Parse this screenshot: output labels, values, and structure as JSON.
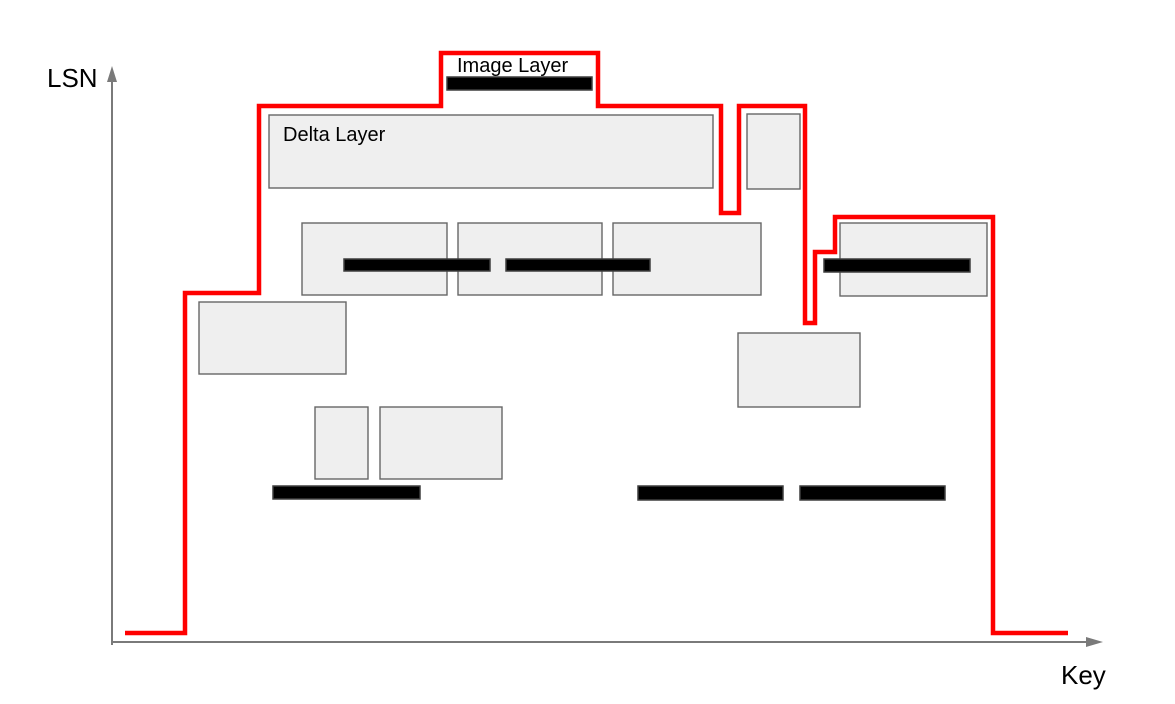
{
  "axes": {
    "y_label": "LSN",
    "x_label": "Key"
  },
  "labels": {
    "image_layer": "Image Layer",
    "delta_layer": "Delta Layer"
  },
  "colors": {
    "red_line": "#ff0000",
    "box_fill": "#efefef",
    "box_stroke": "#666666",
    "bar_fill": "#000000",
    "bar_stroke": "#3f3f3f",
    "axis": "#7a7a7a",
    "text": "#000000",
    "background": "#ffffff"
  },
  "diagram": {
    "red_boundary": {
      "name": "red-boundary-line",
      "points": [
        [
          125,
          633
        ],
        [
          185,
          633
        ],
        [
          185,
          293
        ],
        [
          259,
          293
        ],
        [
          259,
          106
        ],
        [
          441,
          106
        ],
        [
          441,
          53
        ],
        [
          598,
          53
        ],
        [
          598,
          106
        ],
        [
          721,
          106
        ],
        [
          721,
          213
        ],
        [
          739,
          213
        ],
        [
          739,
          106
        ],
        [
          805,
          106
        ],
        [
          805,
          323
        ],
        [
          815,
          323
        ],
        [
          815,
          252
        ],
        [
          835,
          252
        ],
        [
          835,
          217
        ],
        [
          993,
          217
        ],
        [
          993,
          633
        ],
        [
          1068,
          633
        ]
      ]
    },
    "delta_layer_boxes": [
      {
        "name": "delta-layer-box-main",
        "x": 269,
        "y": 115,
        "w": 444,
        "h": 73
      },
      {
        "name": "delta-layer-box-top-small",
        "x": 747,
        "y": 114,
        "w": 53,
        "h": 75
      },
      {
        "name": "delta-layer-box-mid-left",
        "x": 302,
        "y": 223,
        "w": 145,
        "h": 72
      },
      {
        "name": "delta-layer-box-mid-center",
        "x": 458,
        "y": 223,
        "w": 144,
        "h": 72
      },
      {
        "name": "delta-layer-box-mid-right",
        "x": 613,
        "y": 223,
        "w": 148,
        "h": 72
      },
      {
        "name": "delta-layer-box-right",
        "x": 840,
        "y": 223,
        "w": 147,
        "h": 73
      },
      {
        "name": "delta-layer-box-left",
        "x": 199,
        "y": 302,
        "w": 147,
        "h": 72
      },
      {
        "name": "delta-layer-box-bottom-center",
        "x": 738,
        "y": 333,
        "w": 122,
        "h": 74
      },
      {
        "name": "delta-layer-box-small-a",
        "x": 315,
        "y": 407,
        "w": 53,
        "h": 72
      },
      {
        "name": "delta-layer-box-small-b",
        "x": 380,
        "y": 407,
        "w": 122,
        "h": 72
      }
    ],
    "image_layer_bars": [
      {
        "name": "image-layer-bar-top",
        "x": 447,
        "y": 77,
        "w": 145,
        "h": 13
      },
      {
        "name": "image-layer-bar-mid-left",
        "x": 344,
        "y": 259,
        "w": 146,
        "h": 12
      },
      {
        "name": "image-layer-bar-mid-right",
        "x": 506,
        "y": 259,
        "w": 144,
        "h": 12
      },
      {
        "name": "image-layer-bar-right",
        "x": 824,
        "y": 259,
        "w": 146,
        "h": 13
      },
      {
        "name": "image-layer-bar-bottom-left",
        "x": 273,
        "y": 486,
        "w": 147,
        "h": 13
      },
      {
        "name": "image-layer-bar-bottom-center",
        "x": 638,
        "y": 486,
        "w": 145,
        "h": 14
      },
      {
        "name": "image-layer-bar-bottom-right",
        "x": 800,
        "y": 486,
        "w": 145,
        "h": 14
      }
    ]
  }
}
